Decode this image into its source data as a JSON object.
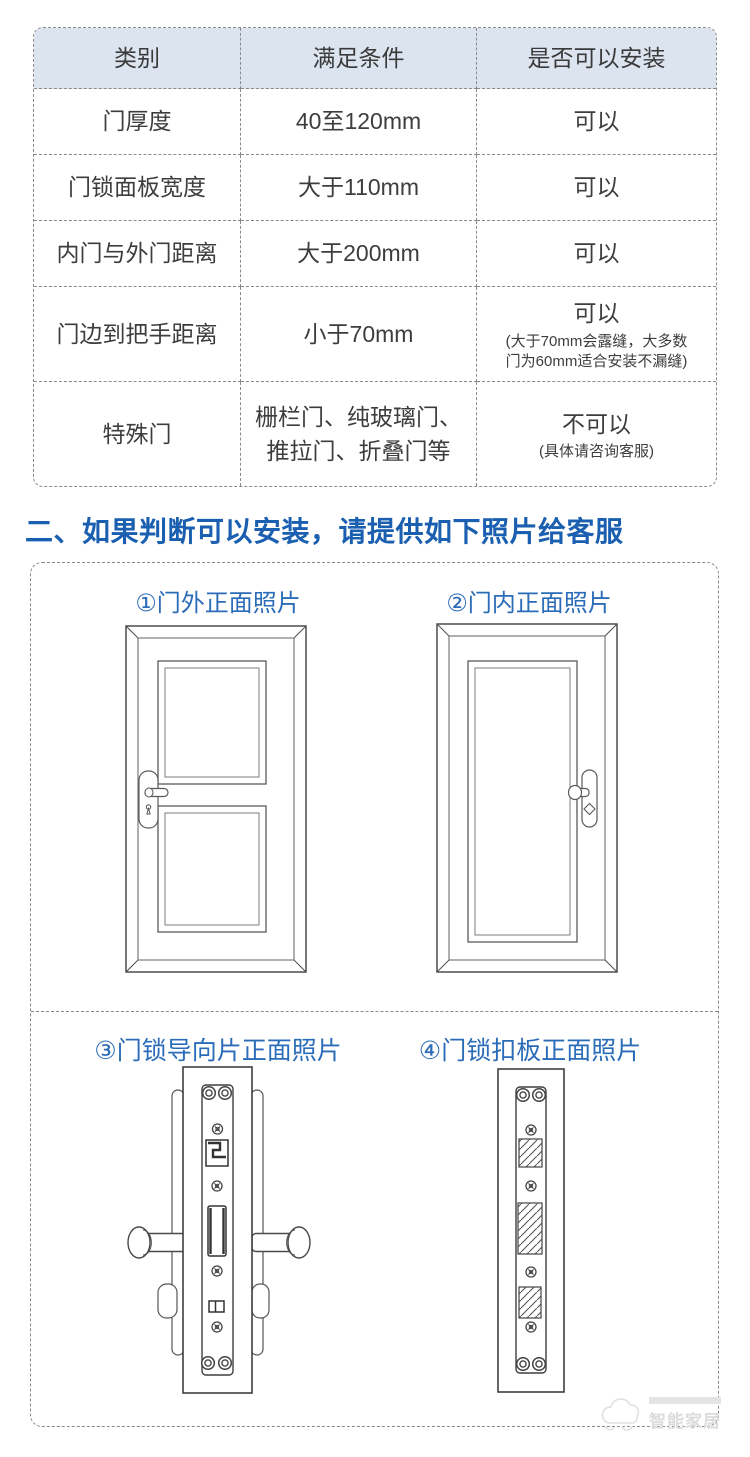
{
  "colors": {
    "accent_blue": "#1a5fb0",
    "label_blue": "#2b6cb8",
    "table_header_bg": "#dce4f0",
    "dashed_border": "#8a8a8a"
  },
  "table": {
    "headers": [
      "类别",
      "满足条件",
      "是否可以安装"
    ],
    "rows": [
      {
        "category": "门厚度",
        "condition": "40至120mm",
        "result": "可以"
      },
      {
        "category": "门锁面板宽度",
        "condition": "大于110mm",
        "result": "可以"
      },
      {
        "category": "内门与外门距离",
        "condition": "大于200mm",
        "result": "可以"
      },
      {
        "category": "门边到把手距离",
        "condition": "小于70mm",
        "result": "可以",
        "note_line1": "(大于70mm会露缝，大多数",
        "note_line2": "门为60mm适合安装不漏缝)"
      },
      {
        "category": "特殊门",
        "condition_line1": "栅栏门、纯玻璃门、",
        "condition_line2": "推拉门、折叠门等",
        "result": "不可以",
        "note_line1": "(具体请咨询客服)"
      }
    ]
  },
  "section_heading": "二、如果判断可以安装，请提供如下照片给客服",
  "photo_labels": {
    "door_exterior": "①门外正面照片",
    "door_interior": "②门内正面照片",
    "lock_guide_plate": "③门锁导向片正面照片",
    "strike_plate": "④门锁扣板正面照片"
  },
  "watermark": {
    "text": "智能家居"
  }
}
